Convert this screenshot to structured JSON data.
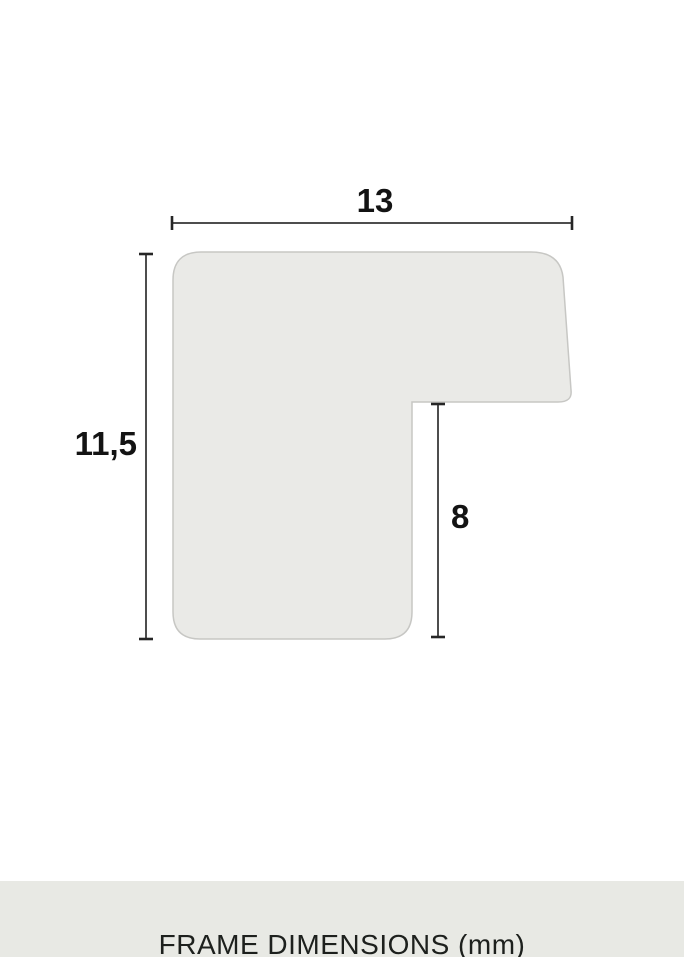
{
  "diagram": {
    "title": "Picture frame moulding cross-section profile",
    "labels": {
      "width": "13",
      "height": "11,5",
      "rabbet_depth": "8"
    },
    "unit": "mm"
  },
  "footer": {
    "caption": "FRAME DIMENSIONS (mm)"
  },
  "colors": {
    "background": "#ffffff",
    "shape_fill": "#eaeae7",
    "shape_stroke": "#c7c7c4",
    "dimension_line": "#4d4d4d",
    "dimension_tick": "#262626",
    "label_text": "#131313",
    "footer_bg": "#e8e9e4",
    "footer_text": "#1d201d"
  }
}
